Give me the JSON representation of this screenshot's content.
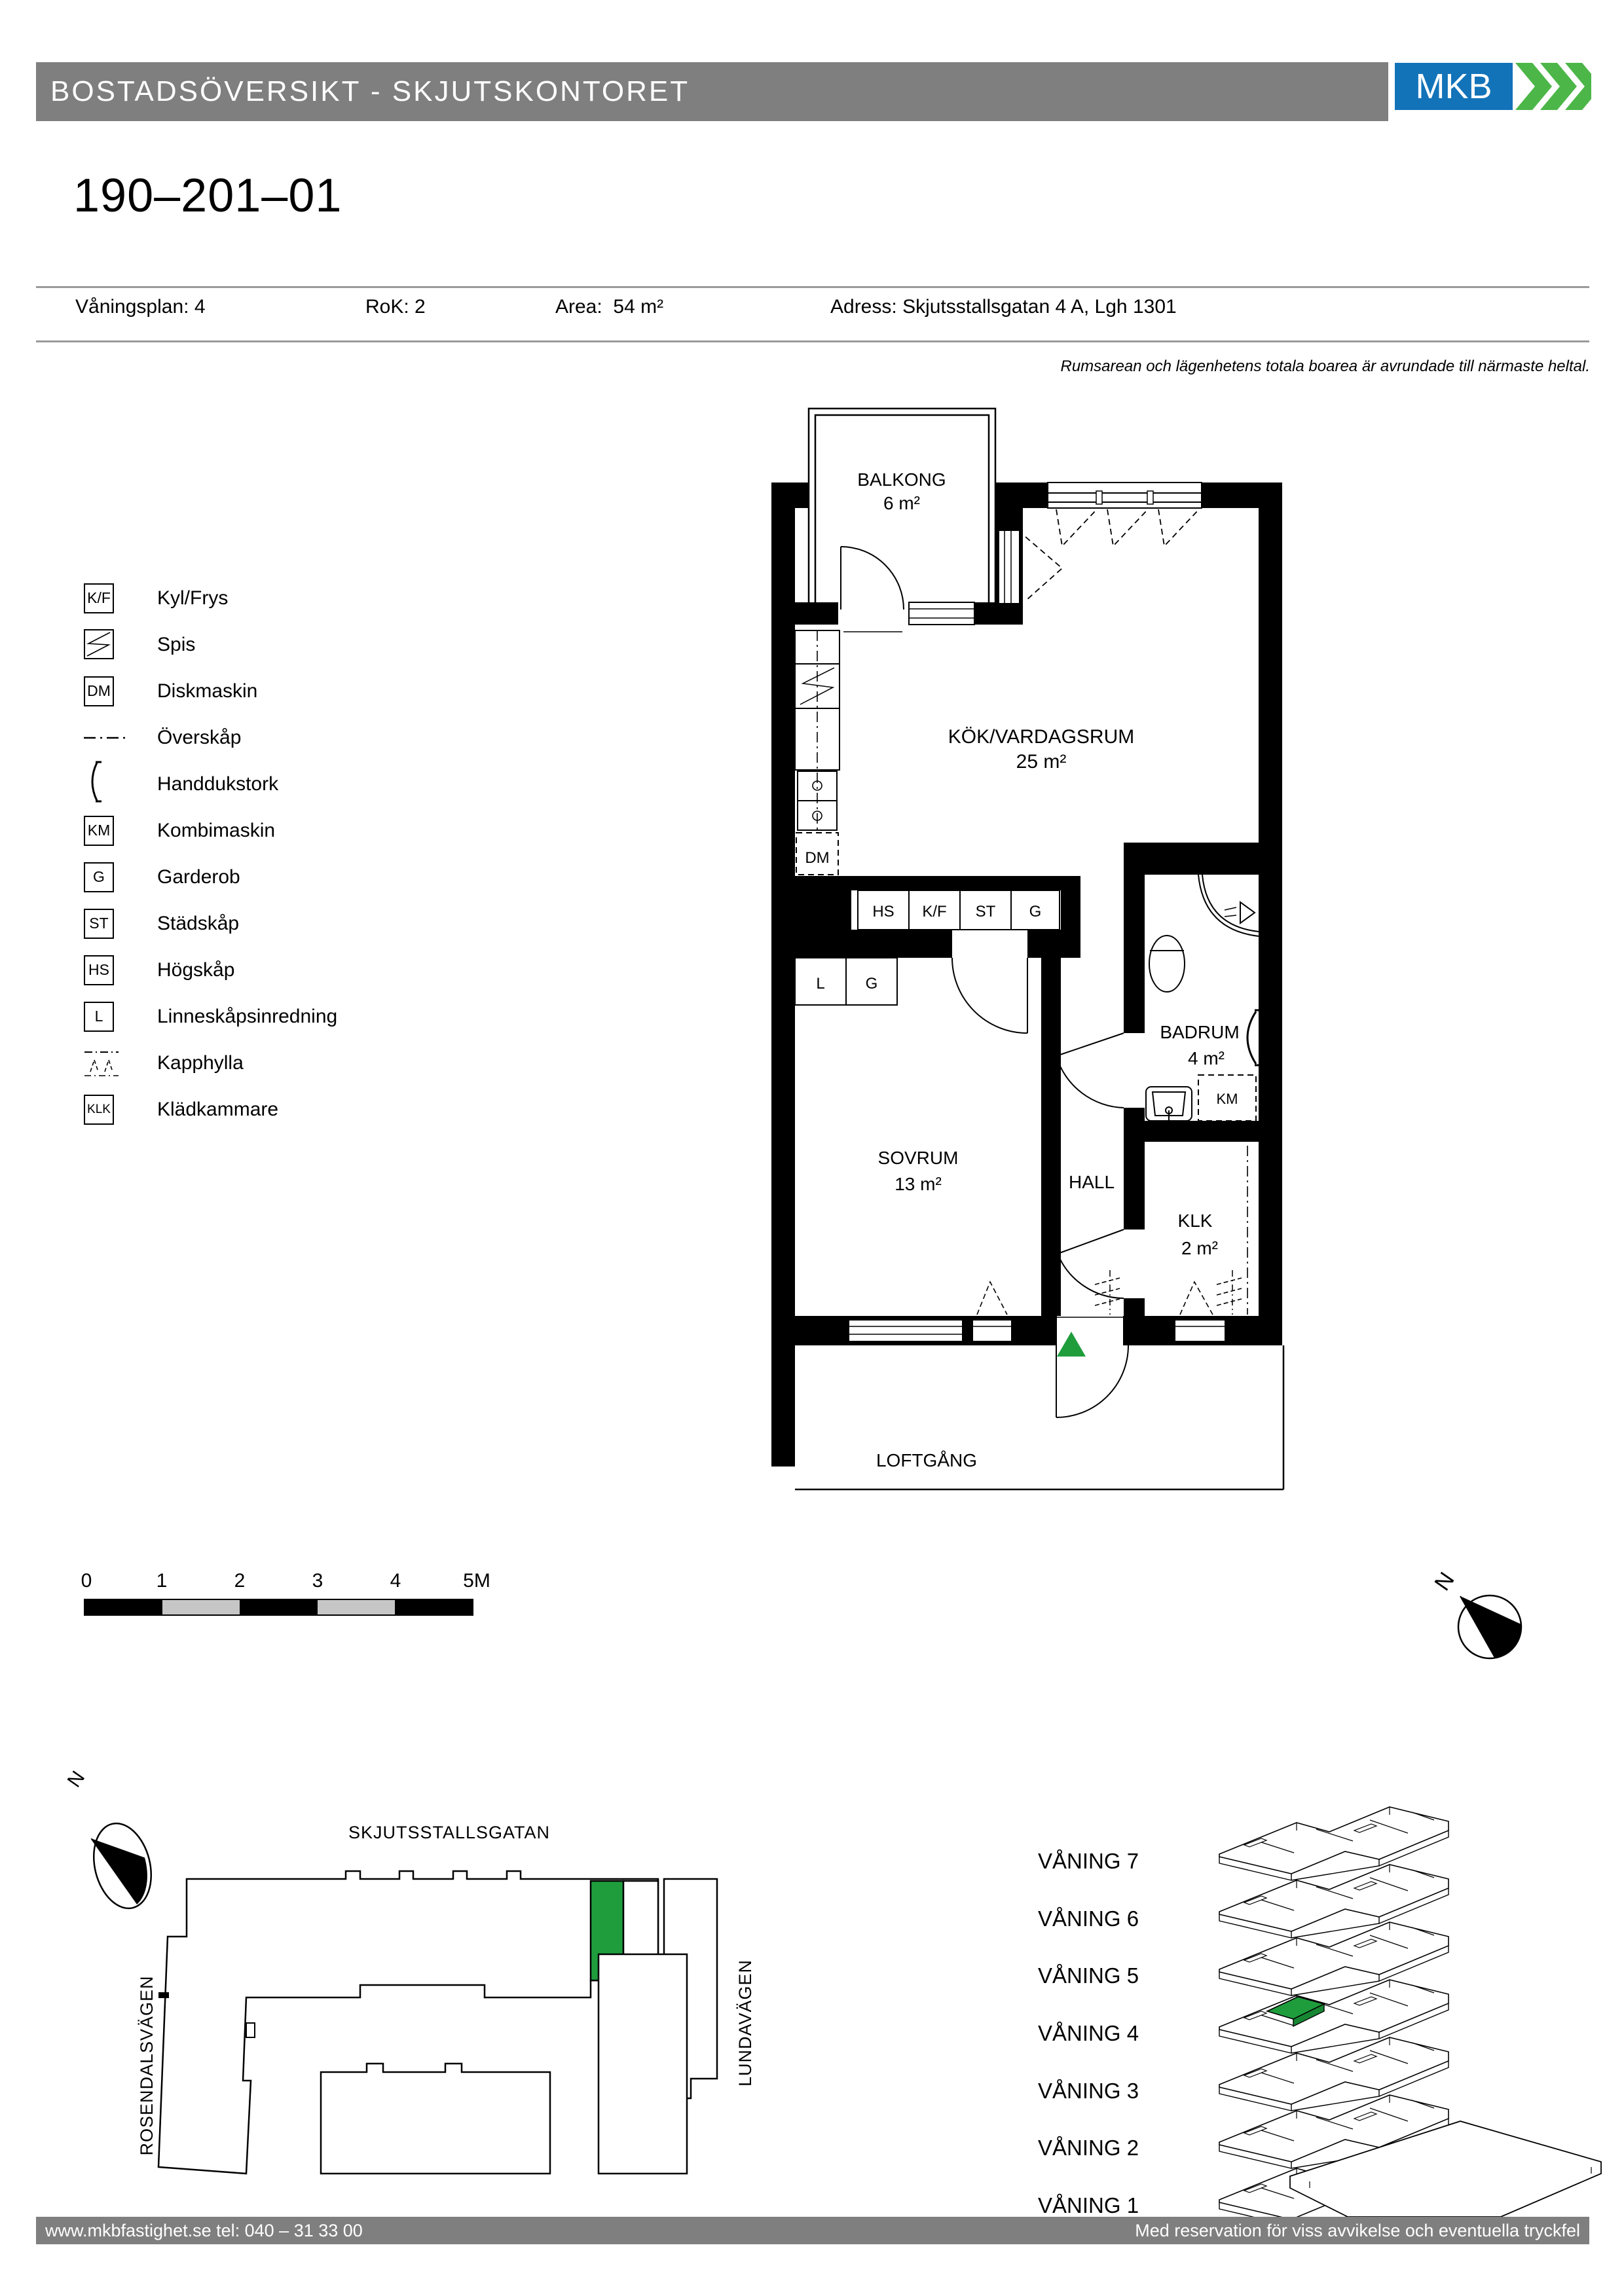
{
  "header": {
    "title": "BOSTADSÖVERSIKT - SKJUTSKONTORET",
    "logo_text": "MKB"
  },
  "apartment": {
    "id": "190–201–01"
  },
  "info": {
    "fields": [
      {
        "label": "Våningsplan:",
        "value": "4"
      },
      {
        "label": "RoK:",
        "value": "2"
      },
      {
        "label": "Area:",
        "value": "54 m²"
      },
      {
        "label": "Adress:",
        "value": "Skjutsstallsgatan 4 A, Lgh 1301"
      }
    ],
    "note": "Rumsarean och lägenhetens totala boarea är avrundade till närmaste heltal."
  },
  "legend": {
    "items": [
      {
        "code": "K/F",
        "label": "Kyl/Frys"
      },
      {
        "code": "",
        "label": "Spis"
      },
      {
        "code": "DM",
        "label": "Diskmaskin"
      },
      {
        "code": "",
        "label": "Överskåp"
      },
      {
        "code": "",
        "label": "Handdukstork"
      },
      {
        "code": "KM",
        "label": "Kombimaskin"
      },
      {
        "code": "G",
        "label": "Garderob"
      },
      {
        "code": "ST",
        "label": "Städskåp"
      },
      {
        "code": "HS",
        "label": "Högskåp"
      },
      {
        "code": "L",
        "label": "Linneskåpsinredning"
      },
      {
        "code": "",
        "label": "Kapphylla"
      },
      {
        "code": "KLK",
        "label": "Klädkammare"
      }
    ]
  },
  "plan": {
    "rooms": [
      {
        "name": "BALKONG",
        "area": "6 m²"
      },
      {
        "name": "KÖK/VARDAGSRUM",
        "area": "25 m²"
      },
      {
        "name": "SOVRUM",
        "area": "13 m²"
      },
      {
        "name": "HALL",
        "area": ""
      },
      {
        "name": "BADRUM",
        "area": "4 m²"
      },
      {
        "name": "KLK",
        "area": "2 m²"
      },
      {
        "name": "LOFTGÅNG",
        "area": ""
      }
    ],
    "fixtures": {
      "hs": "HS",
      "kf": "K/F",
      "st": "ST",
      "g1": "G",
      "l": "L",
      "g2": "G",
      "dm": "DM",
      "km": "KM"
    }
  },
  "scalebar": {
    "labels": [
      "0",
      "1",
      "2",
      "3",
      "4",
      "5M"
    ]
  },
  "sitemap": {
    "streets": [
      "SKJUTSSTALLSGATAN",
      "ROSENDALSVÄGEN",
      "LUNDAVÄGEN"
    ],
    "north_label": "N"
  },
  "floors": {
    "items": [
      {
        "label": "VÅNING 7"
      },
      {
        "label": "VÅNING 6"
      },
      {
        "label": "VÅNING 5"
      },
      {
        "label": "VÅNING 4"
      },
      {
        "label": "VÅNING 3"
      },
      {
        "label": "VÅNING 2"
      },
      {
        "label": "VÅNING 1"
      }
    ],
    "highlighted": "VÅNING 4"
  },
  "footer": {
    "left": "www.mkbfastighet.se   tel: 040 – 31 33 00",
    "right": "Med reservation för viss avvikelse och eventuella tryckfel"
  },
  "colors": {
    "unit_green": "#1f9d3d",
    "mkb_blue": "#1273b9",
    "mkb_green": "#4cb648",
    "bar_gray": "#7f7f7f"
  }
}
